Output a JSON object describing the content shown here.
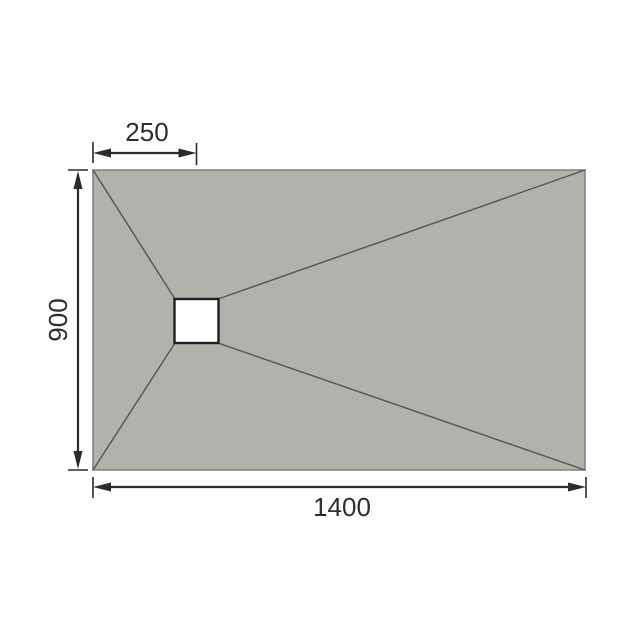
{
  "drawing": {
    "dimension_labels": {
      "drain_offset": "250",
      "tray_depth": "900",
      "tray_width": "1400"
    },
    "colors": {
      "background": "#ffffff",
      "tray_fill": "#b2b2ac",
      "tray_border": "#858580",
      "fold_line": "#55554f",
      "dimension_line": "#2b2b2b",
      "label_text": "#2e2e2e",
      "drain_fill": "#ffffff",
      "drain_border": "#1f1f1f"
    },
    "icons": {
      "arrowhead": "filled-triangle"
    }
  }
}
